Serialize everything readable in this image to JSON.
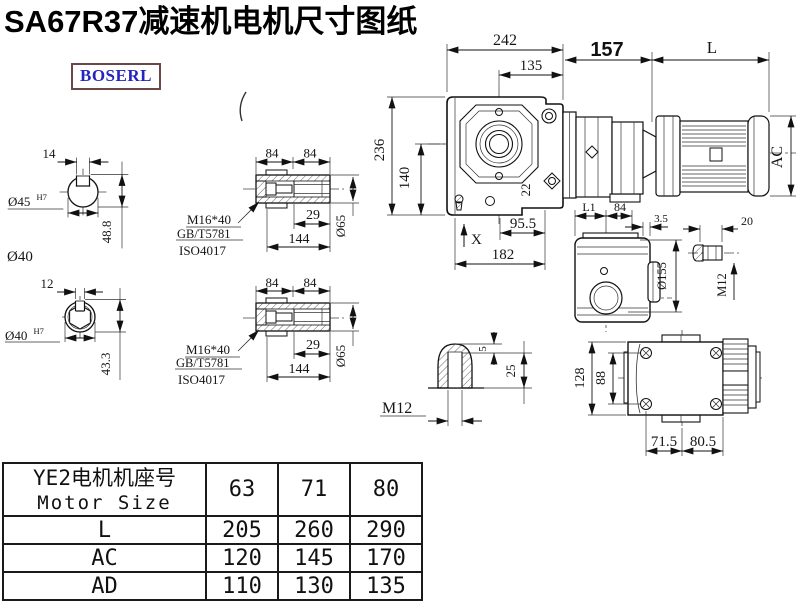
{
  "title": "SA67R37减速机电机尺寸图纸",
  "brand": {
    "logo_text": "BOSERL"
  },
  "drawing": {
    "shaft_end_top": {
      "key_width": "14",
      "bore": "Ø45",
      "bore_tol": "H7",
      "height": "48.8",
      "outer_dia": "Ø40"
    },
    "shaft_end_bottom": {
      "key_width": "12",
      "bore": "Ø40",
      "bore_tol": "H7",
      "height": "43.3"
    },
    "hollow_shaft": {
      "len_a": "84",
      "len_b": "84",
      "bolt_spec": "M16*40",
      "std_gb": "GB/T5781",
      "std_iso": "ISO4017",
      "bore_depth": "29",
      "total_len": "144",
      "dia": "Ø65"
    },
    "front_view": {
      "width": "242",
      "center_offset": "135",
      "adapter_len": "157",
      "motor_len": "L",
      "height": "236",
      "axis_height": "140",
      "flange_thk": "22",
      "mark_x": "X",
      "foot_offset": "95.5",
      "foot_len": "182",
      "motor_dia": "AC"
    },
    "side_view": {
      "l1": "L1",
      "d84": "84",
      "d35": "3.5",
      "d20": "20",
      "dia155": "Ø155",
      "m12": "M12"
    },
    "key_detail": {
      "d5": "5",
      "d25": "25",
      "m12": "M12"
    },
    "bottom_view": {
      "d128": "128",
      "d88": "88",
      "d715": "71.5",
      "d805": "80.5"
    }
  },
  "table": {
    "header": {
      "line1": "YE2电机机座号",
      "line2": "Motor Size"
    },
    "columns": [
      "63",
      "71",
      "80"
    ],
    "rows": [
      {
        "label": "L",
        "values": [
          "205",
          "260",
          "290"
        ]
      },
      {
        "label": "AC",
        "values": [
          "120",
          "145",
          "170"
        ]
      },
      {
        "label": "AD",
        "values": [
          "110",
          "130",
          "135"
        ]
      }
    ]
  },
  "colors": {
    "ink": "#111111",
    "logo_text": "#2424c0",
    "logo_border": "#6b4747",
    "background": "#ffffff"
  }
}
